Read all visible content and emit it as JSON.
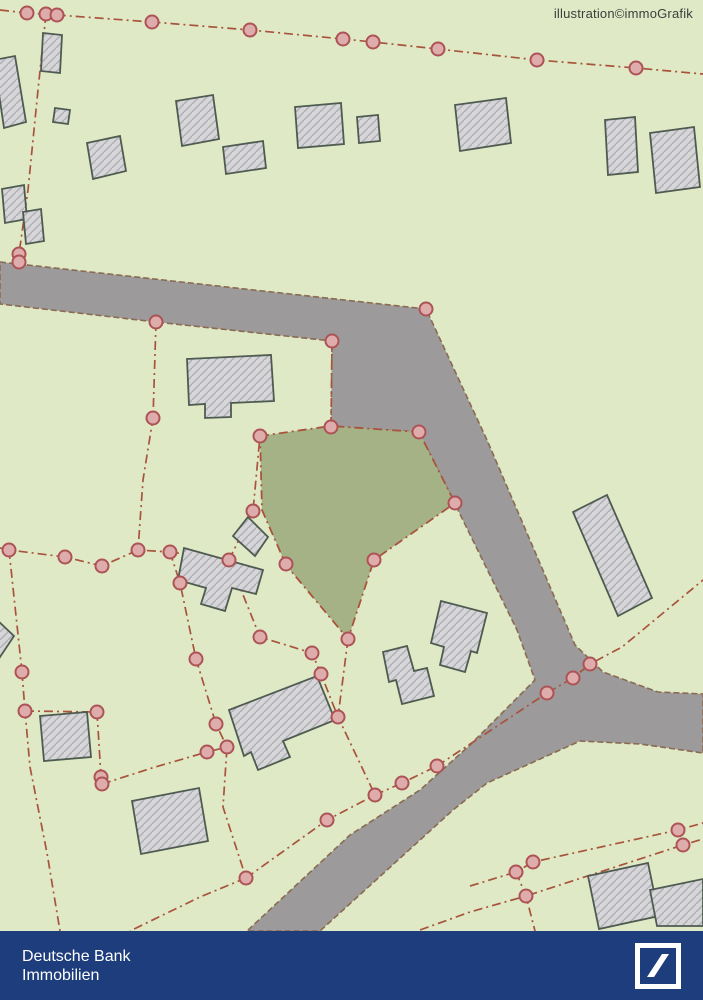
{
  "watermark": "illustration©immoGrafik",
  "footer": {
    "brand_line1": "Deutsche Bank",
    "brand_line2": "Immobilien",
    "bar_color": "#1e3d7c"
  },
  "map": {
    "colors": {
      "background": "#dfe9c6",
      "road": "#9d9a9c",
      "road_edge": "#8a6a50",
      "boundary": "#a8543c",
      "marker_fill": "#dfacac",
      "marker_stroke": "#ad5356",
      "building_fill": "#d6d6d9",
      "building_hatch": "#aeaeb4",
      "building_stroke": "#4f5b51",
      "highlight_parcel": "#a5b285"
    },
    "road_polygons": [
      "0,262 426,309 487,440 575,645 603,672 658,692 703,694 703,753 640,744 580,741 487,783 453,810 320,931 247,931 350,835 420,790 470,745 535,680 517,630 455,504 419,432 331,427 332,341 156,322 0,304"
    ],
    "highlight_parcel_polygon": "260,436 331,426 419,432 455,503 374,560 348,639 286,565 262,510",
    "boundary_lines": [
      "0,10 27,13 46,14 57,15 152,22 250,30 343,39 373,42 438,49 537,60 636,68 703,74",
      "46,14 38,90 28,190 19,254 19,262",
      "332,341 331,427",
      "156,322 153,418 143,480 138,550",
      "0,548 9,550 65,557 102,566 138,550 170,552",
      "170,552 180,583 196,659",
      "170,552 229,560",
      "229,560 253,511 260,436",
      "196,659 216,724 227,747 223,807 246,878",
      "22,672 25,711 30,767 47,853 60,931",
      "25,711 97,712",
      "97,712 101,777 102,784",
      "102,784 152,768 207,752 227,747",
      "246,878 200,897 130,931",
      "246,878 327,820 375,795",
      "375,795 402,783 437,766",
      "437,766 547,693 573,678 590,664 622,647 697,585 703,580",
      "348,639 338,717 375,795",
      "229,560 260,637 312,653 321,674 338,717",
      "470,886 516,872 533,862 678,830 703,823",
      "420,930 470,912 526,896 683,845 703,839",
      "516,872 526,896 535,931",
      "9,550 22,672"
    ],
    "markers": [
      [
        27,
        13
      ],
      [
        46,
        14
      ],
      [
        57,
        15
      ],
      [
        152,
        22
      ],
      [
        250,
        30
      ],
      [
        343,
        39
      ],
      [
        373,
        42
      ],
      [
        438,
        49
      ],
      [
        537,
        60
      ],
      [
        636,
        68
      ],
      [
        19,
        254
      ],
      [
        19,
        262
      ],
      [
        156,
        322
      ],
      [
        332,
        341
      ],
      [
        426,
        309
      ],
      [
        153,
        418
      ],
      [
        9,
        550
      ],
      [
        65,
        557
      ],
      [
        102,
        566
      ],
      [
        138,
        550
      ],
      [
        170,
        552
      ],
      [
        180,
        583
      ],
      [
        229,
        560
      ],
      [
        196,
        659
      ],
      [
        260,
        436
      ],
      [
        331,
        427
      ],
      [
        419,
        432
      ],
      [
        455,
        503
      ],
      [
        374,
        560
      ],
      [
        348,
        639
      ],
      [
        286,
        564
      ],
      [
        253,
        511
      ],
      [
        260,
        637
      ],
      [
        312,
        653
      ],
      [
        321,
        674
      ],
      [
        338,
        717
      ],
      [
        22,
        672
      ],
      [
        25,
        711
      ],
      [
        97,
        712
      ],
      [
        101,
        777
      ],
      [
        102,
        784
      ],
      [
        216,
        724
      ],
      [
        207,
        752
      ],
      [
        227,
        747
      ],
      [
        375,
        795
      ],
      [
        402,
        783
      ],
      [
        437,
        766
      ],
      [
        327,
        820
      ],
      [
        246,
        878
      ],
      [
        547,
        693
      ],
      [
        573,
        678
      ],
      [
        590,
        664
      ],
      [
        516,
        872
      ],
      [
        533,
        862
      ],
      [
        526,
        896
      ],
      [
        678,
        830
      ],
      [
        683,
        845
      ]
    ],
    "buildings": [
      "-6,60 15,56 26,122 4,128",
      "43,33 62,35 60,73 41,71",
      "55,108 70,110 68,124 53,122",
      "87,143 120,136 126,171 93,179",
      "176,101 213,95 219,139 182,146",
      "223,147 263,141 266,168 226,174",
      "295,107 341,103 344,144 298,148",
      "357,117 378,115 380,141 359,143",
      "455,105 506,98 511,143 460,151",
      "605,120 635,117 638,172 608,175",
      "650,133 694,127 700,187 656,193",
      "2,189 24,185 27,219 5,223",
      "23,212 41,209 44,241 26,244",
      "187,359 271,355 274,401 231,403 231,417 205,418 205,404 189,405",
      "248,517 268,537 255,556 233,536",
      "184,548 263,570 256,594 232,588 225,611 201,604 206,588 178,580",
      "229,710 317,676 335,720 283,741 290,757 258,770 251,752 244,756",
      "40,716 87,712 91,757 44,761",
      "132,801 199,788 208,841 141,854",
      "383,652 407,646 414,671 427,668 434,696 402,704 396,680 389,682",
      "441,601 487,613 477,653 471,651 465,672 440,665 444,647 431,643",
      "573,512 607,495 652,598 618,616",
      "-5,618 14,636 -2,660",
      "588,876 648,863 659,916 599,929",
      "650,890 703,879 703,926 657,926"
    ]
  }
}
